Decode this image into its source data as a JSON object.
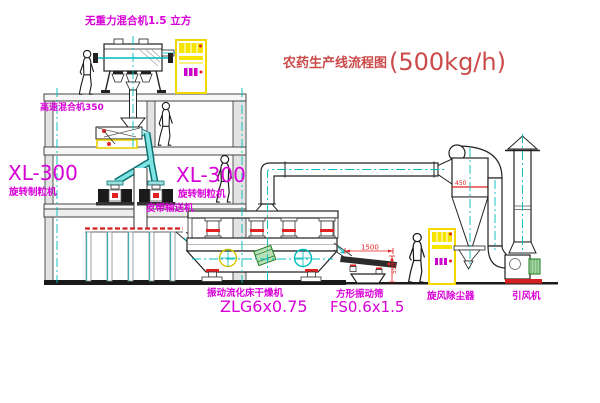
{
  "title": {
    "name": "农药生产线流程图",
    "capacity": "(500kg/h)"
  },
  "equipment": {
    "gravity_mixer": {
      "label": "无重力混合机1.5 立方"
    },
    "high_speed_mixer": {
      "label": "高速混合机350"
    },
    "granulator_left": {
      "model": "XL-300",
      "name": "旋转制粒机"
    },
    "granulator_right": {
      "model": "XL-300",
      "name": "旋转制粒机"
    },
    "belt_conveyor": {
      "label": "皮带输送机"
    },
    "fluid_bed_dryer": {
      "name": "振动流化床干燥机",
      "model": "ZLG6x0.75"
    },
    "vibrating_sieve": {
      "name": "方形振动筛",
      "model": "FS0.6x1.5"
    },
    "cyclone": {
      "name": "旋风除尘器"
    },
    "fan": {
      "name": "引风机"
    }
  },
  "dimensions": {
    "sieve_length": "1500",
    "sieve_outlet_height": "550",
    "cyclone_size": "450"
  },
  "colors": {
    "label_magenta": "#d800d8",
    "title_red": "#cb4a4a",
    "dimension_red": "#e02020",
    "cabinet_yellow": "#f7e400",
    "centerline_cyan": "#00bcbc",
    "pipe_cyan": "#7fe3e3",
    "motor_green": "#1f7a1f",
    "line_black": "#1a1a1a"
  }
}
